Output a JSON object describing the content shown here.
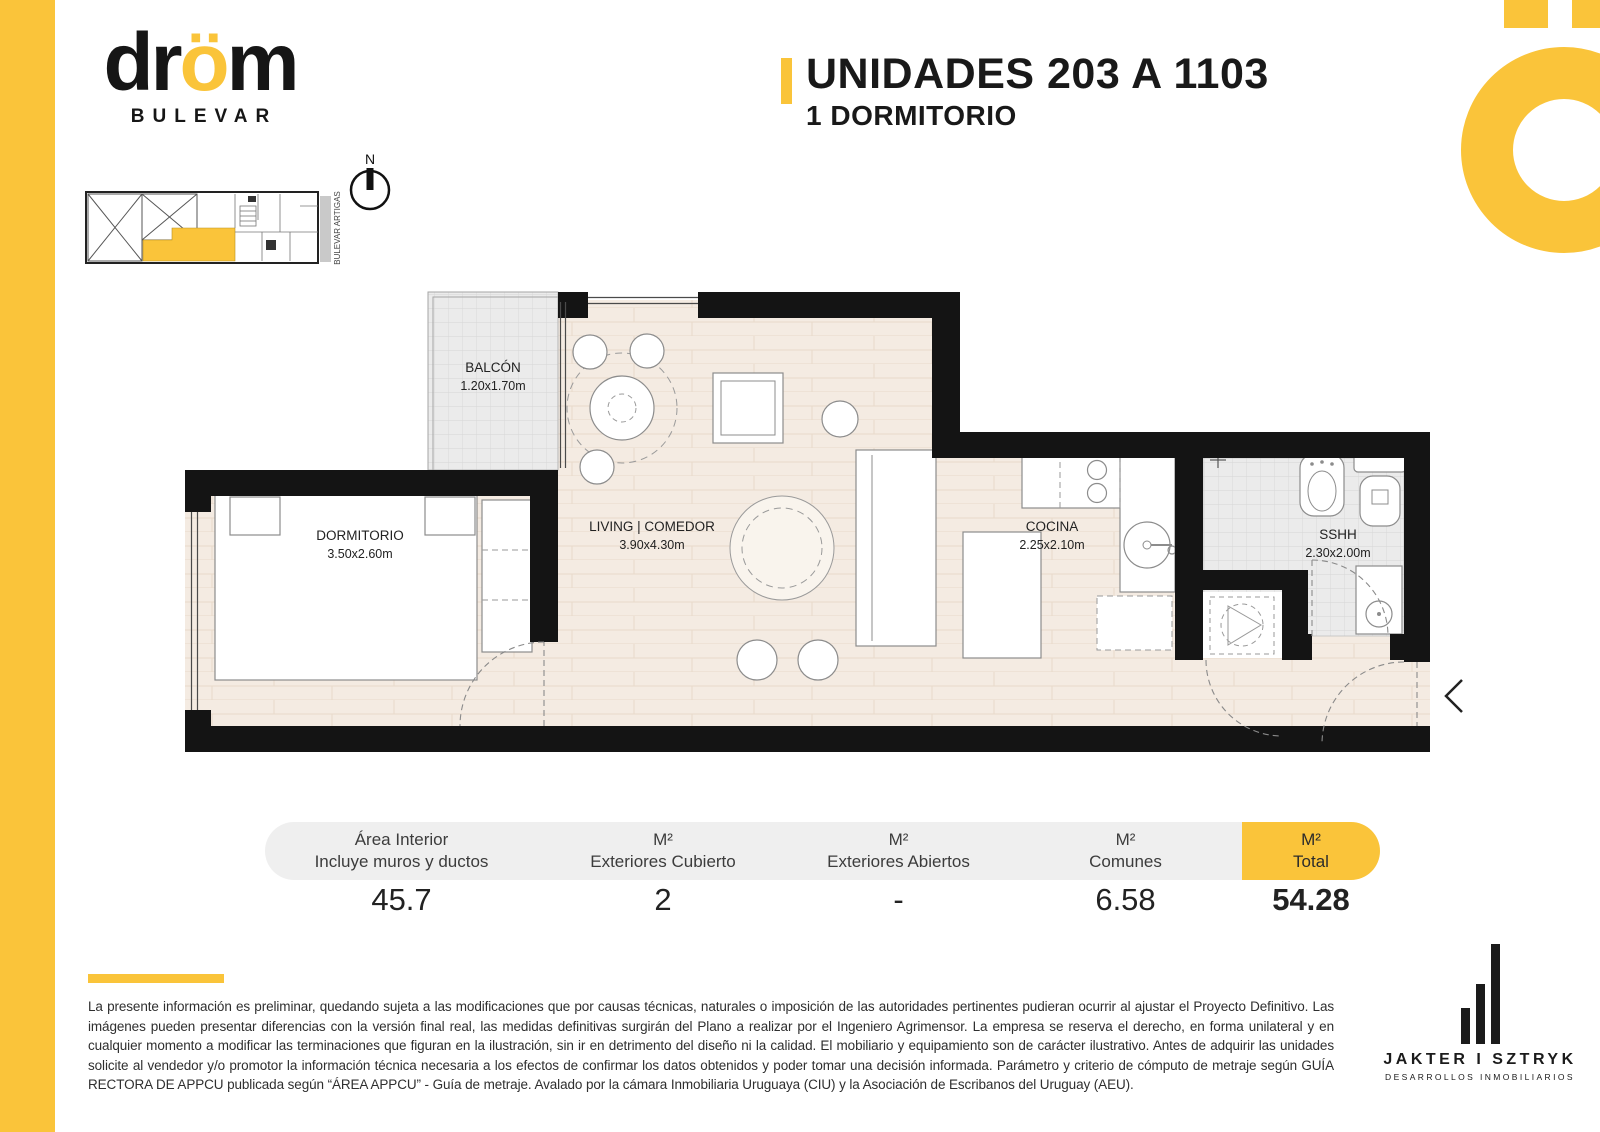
{
  "page": {
    "accent": "#FAC43A",
    "wall_color": "#141414",
    "background": "#ffffff"
  },
  "brand": {
    "logo_d": "dr",
    "logo_o": "ö",
    "logo_m": "m",
    "sub": "BULEVAR"
  },
  "header": {
    "title": "UNIDADES 203 A 1103",
    "subtitle": "1 DORMITORIO"
  },
  "keyplan": {
    "street_label": "BULEVAR ARTIGAS",
    "north_label": "N"
  },
  "floorplan": {
    "rooms": [
      {
        "name": "BALCÓN",
        "dims": "1.20x1.70m"
      },
      {
        "name": "DORMITORIO",
        "dims": "3.50x2.60m"
      },
      {
        "name": "LIVING | COMEDOR",
        "dims": "3.90x4.30m"
      },
      {
        "name": "COCINA",
        "dims": "2.25x2.10m"
      },
      {
        "name": "SSHH",
        "dims": "2.30x2.00m"
      }
    ]
  },
  "areas_table": {
    "columns": [
      {
        "line1": "Área Interior",
        "line2": "Incluye muros y ductos",
        "value": "45.7"
      },
      {
        "line1": "M²",
        "line2": "Exteriores Cubierto",
        "value": "2"
      },
      {
        "line1": "M²",
        "line2": "Exteriores Abiertos",
        "value": "-"
      },
      {
        "line1": "M²",
        "line2": "Comunes",
        "value": "6.58"
      },
      {
        "line1": "M²",
        "line2": "Total",
        "value": "54.28"
      }
    ]
  },
  "disclaimer": "La presente información es preliminar, quedando sujeta a las modificaciones que por causas técnicas, naturales o imposición de las autoridades pertinentes pudieran ocurrir al ajustar el Proyecto Definitivo. Las imágenes pueden presentar diferencias con la versión final real, las medidas definitivas surgirán del Plano a realizar por el Ingeniero Agrimensor. La empresa se reserva el derecho, en forma unilateral y en cualquier momento a modificar las terminaciones que figuran en la ilustración, sin ir en detrimento del diseño ni la calidad. El mobiliario y equipamiento son de carácter ilustrativo. Antes de adquirir las unidades solicite al vendedor y/o promotor la información técnica necesaria a los efectos de confirmar los datos obtenidos y poder tomar una decisión informada. Parámetro y criterio de cómputo de metraje según GUÍA RECTORA DE APPCU publicada según “ÁREA APPCU” - Guía de metraje. Avalado por la cámara Inmobiliaria Uruguaya (CIU) y la Asociación de Escribanos del Uruguay (AEU).",
  "developer": {
    "name": "JAKTER I SZTRYK",
    "tagline": "DESARROLLOS INMOBILIARIOS"
  }
}
